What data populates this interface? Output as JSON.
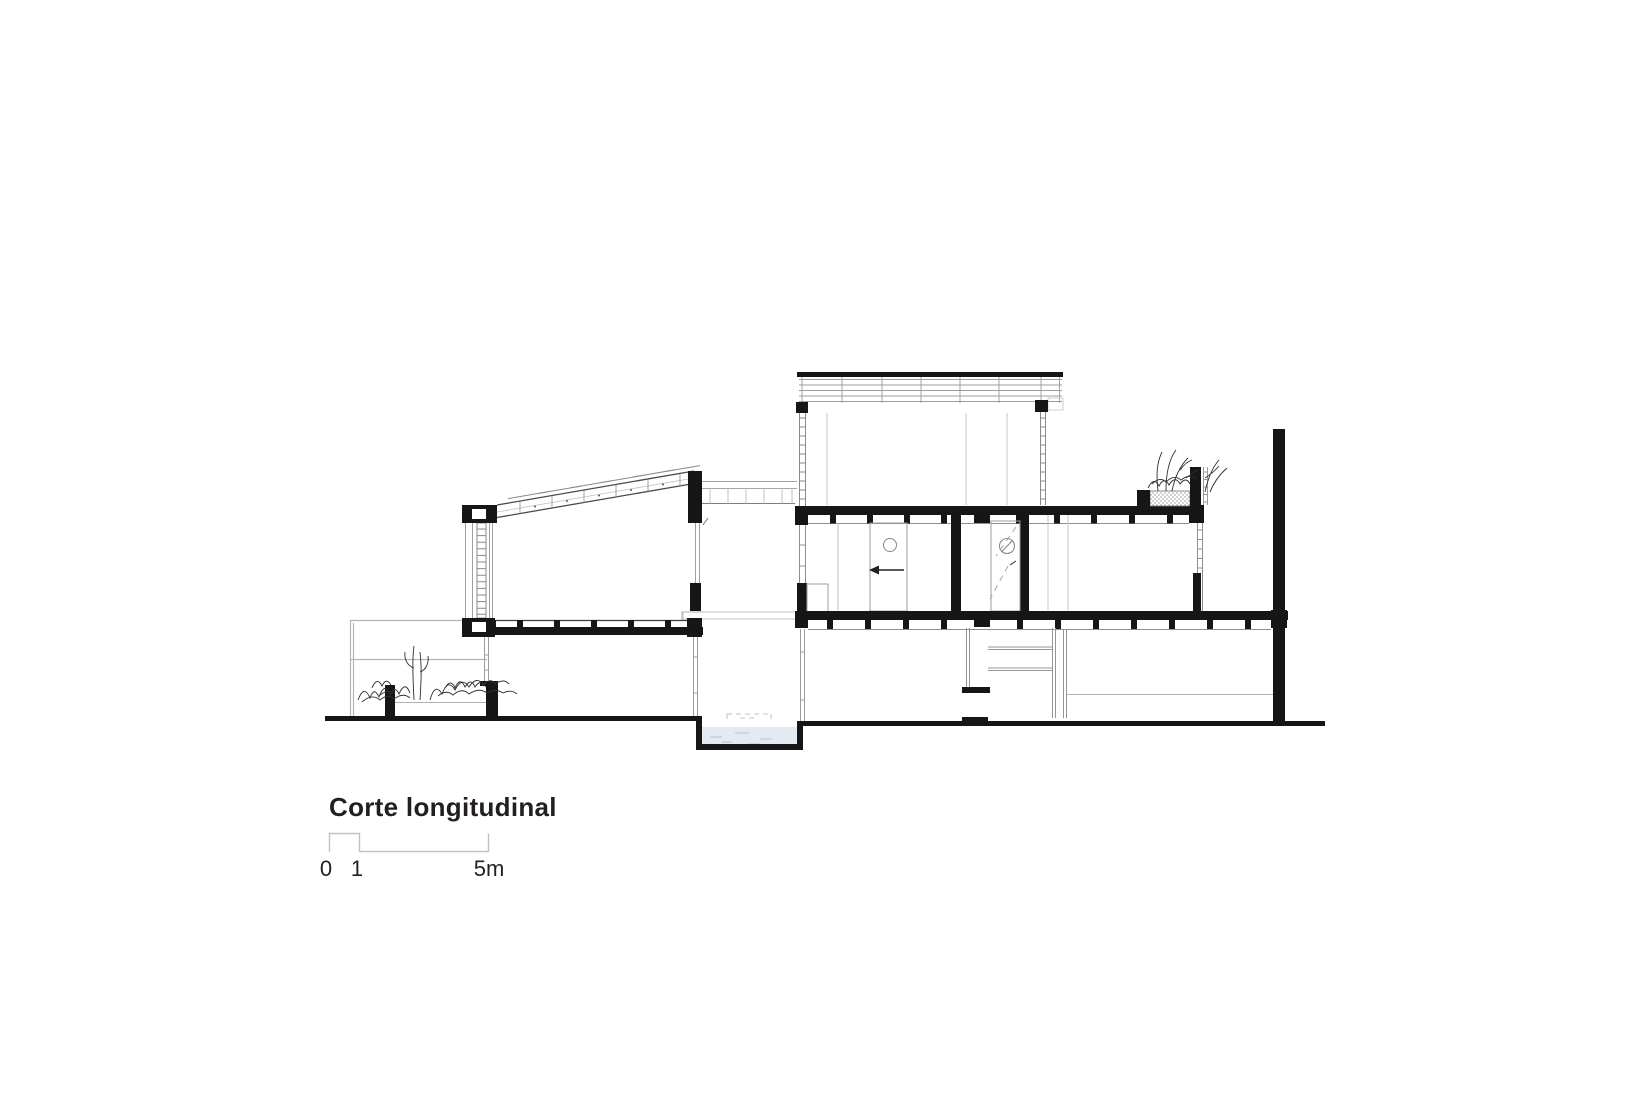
{
  "page": {
    "background": "#ffffff"
  },
  "title": "Corte longitudinal",
  "scale_bar": {
    "labels": [
      "0",
      "1",
      "5m"
    ]
  },
  "drawing": {
    "type": "architectural-longitudinal-section",
    "ink_color": "#1a1a1a",
    "light_line_color": "#a3a3a3",
    "faint_line_color": "#c6c6c6",
    "water_color": "#e4eaf4"
  }
}
